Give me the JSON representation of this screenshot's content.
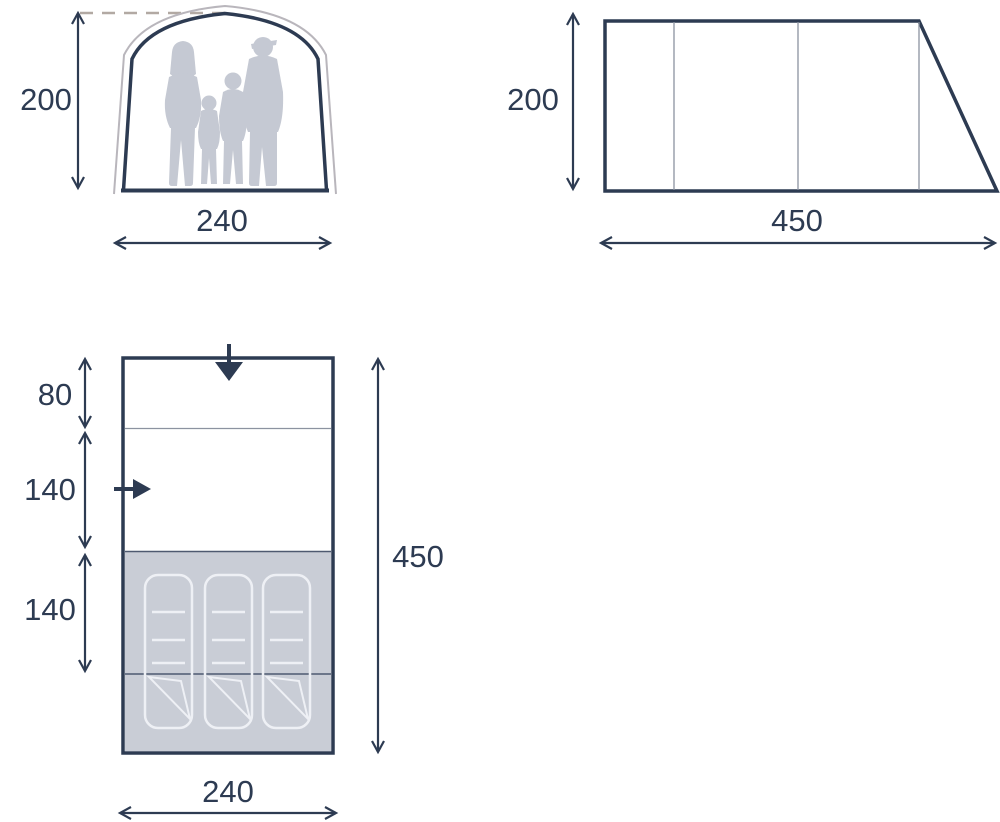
{
  "diagram": {
    "colors": {
      "line": "#2d3b52",
      "outer_line": "#b9b6bc",
      "divider": "#8c93a0",
      "dark_divider": "#4e5a70",
      "area_fill": "#c9cdd6",
      "silhouette": "#c5c9d3",
      "bag_outline": "#eef0f5",
      "dashed": "#b2a9a3",
      "background": "#ffffff"
    },
    "front_view": {
      "height": "200",
      "width": "240",
      "people_count": 4
    },
    "side_view": {
      "height": "200",
      "length": "450",
      "panel_divider_count": 3
    },
    "floor_plan": {
      "porch_depth": "80",
      "living_depth": "140",
      "sleeping_depth": "140",
      "total_length": "450",
      "width": "240",
      "sleeping_bag_count": 3
    }
  }
}
